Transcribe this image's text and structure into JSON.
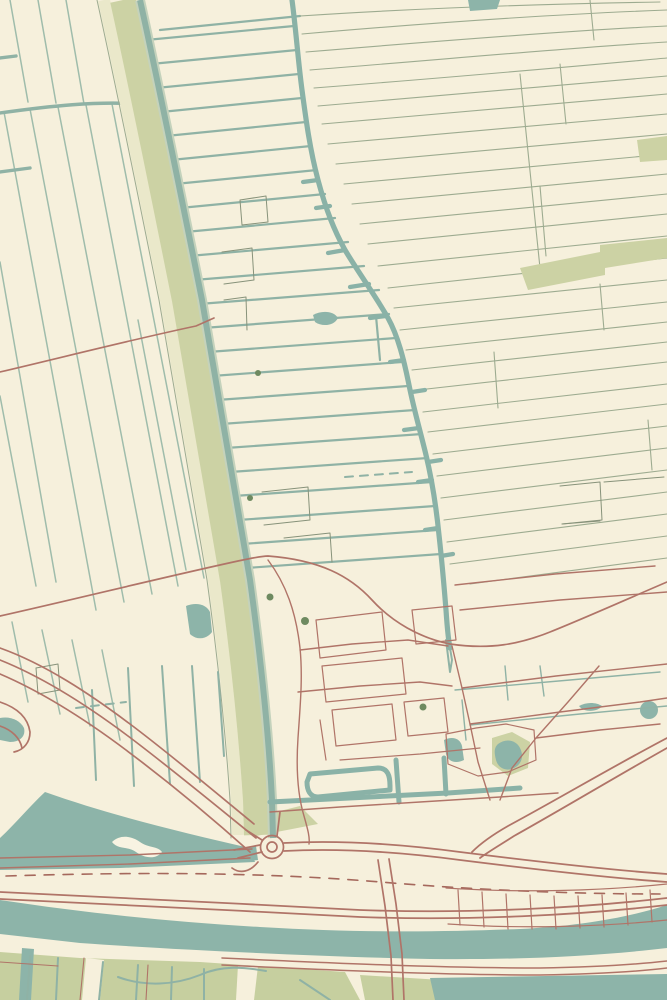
{
  "artwork": {
    "kind": "vintage-style topographic map print",
    "visible_text": "none"
  },
  "palette": {
    "cream": "#f6f0dc",
    "cream_light": "#f8f3e2",
    "water": "#8db4a9",
    "water_deep": "#8ab2a7",
    "ditch": "#8fb2a5",
    "ditch_light": "#9fbcab",
    "field_line": "#9dab90",
    "dark_line": "#87927a",
    "green_band": "#ccd2a4",
    "pale_band": "#eae8ca",
    "olive_field": "#c6cf9f",
    "road_red": "#b07468",
    "road_red_dark": "#a5685c",
    "tree_green": "#6e8a60",
    "casing": "#c4d2bc"
  },
  "map": {
    "width": 667,
    "height": 1000,
    "layers": [
      {
        "name": "background",
        "style": {
          "fill": "cream"
        },
        "paths": [
          "M0,0 H667 V1000 H0 Z"
        ]
      },
      {
        "name": "left-field-lines",
        "style": {
          "stroke": "ditch_light",
          "width": 1.5
        },
        "paths": [
          "M10,0 L28,102",
          "M38,0 L56,103",
          "M66,0 L84,104",
          "M4,112 L96,610",
          "M30,109 L124,602",
          "M58,107 L152,594",
          "M86,105 L178,586",
          "M112,104 L204,578",
          "M0,262 L56,582",
          "M0,396 L36,586",
          "M138,320 L186,570",
          "M12,622 L28,702",
          "M42,630 L60,714",
          "M72,640 L90,726",
          "M102,650 L120,740"
        ]
      },
      {
        "name": "left-cross-ditches",
        "style": {
          "stroke": "ditch",
          "width": 3.4
        },
        "paths": [
          "M0,113 C50,106 96,101 140,104",
          "M0,58 L16,56",
          "M0,172 L30,168"
        ]
      },
      {
        "name": "middle-ditch-lines",
        "style": {
          "stroke": "ditch",
          "width": 2.2
        },
        "paths": [
          "M146,40 L294,26",
          "M151,64 L297,50",
          "M156,88 L299,74",
          "M161,112 L302,98",
          "M166,136 L306,122",
          "M171,160 L311,146",
          "M175,184 L317,170",
          "M180,208 L325,194",
          "M185,232 L335,218",
          "M189,256 L348,242",
          "M194,280 L364,266",
          "M199,304 L379,290",
          "M203,328 L389,314",
          "M208,352 L396,338",
          "M212,376 L402,362",
          "M217,400 L408,386",
          "M221,424 L415,410",
          "M226,448 L422,434",
          "M230,472 L428,458",
          "M234,496 L432,482",
          "M238,520 L435,506",
          "M242,544 L438,530",
          "M246,568 L441,554",
          "M376,316 L380,360",
          "M300,16 L160,30"
        ]
      },
      {
        "name": "right-field-lines",
        "style": {
          "stroke": "field_line",
          "width": 1.1
        },
        "paths": [
          "M300,16 C420,8 540,4 660,2",
          "M302,34 C440,22 560,14 667,10",
          "M306,52 C450,40 580,30 667,26",
          "M310,70 C460,58 590,46 667,42",
          "M314,88 C470,76 600,64 667,58",
          "M318,106 L667,76",
          "M322,124 L667,94",
          "M328,144 L667,114",
          "M336,164 L667,134",
          "M344,184 L667,154",
          "M352,204 L667,174",
          "M360,224 L667,194",
          "M368,244 L667,214",
          "M378,266 L667,236",
          "M388,288 L667,258",
          "M394,308 L667,280",
          "M400,330 L667,302",
          "M406,350 L667,322",
          "M412,370 L667,342",
          "M418,390 L667,362",
          "M423,412 L667,384",
          "M428,432 L667,404",
          "M433,454 L667,426",
          "M437,476 L667,448",
          "M441,498 L667,470",
          "M444,520 L667,492",
          "M447,542 L667,514",
          "M450,564 L667,536",
          "M470,584 L667,558"
        ]
      },
      {
        "name": "right-field-connectors",
        "style": {
          "stroke": "field_line",
          "width": 1.1
        },
        "paths": [
          "M560,64 L566,124",
          "M540,186 L546,256",
          "M520,74 C527,140 534,205 540,268",
          "M494,352 L498,408",
          "M648,420 L652,470",
          "M600,284 L604,330",
          "M590,0 L594,40"
        ]
      },
      {
        "name": "dashed-ditches",
        "style": {
          "stroke": "ditch",
          "width": 2,
          "dash": "8,7"
        },
        "paths": [
          "M76,708 L126,702",
          "M345,477 L412,472"
        ]
      },
      {
        "name": "thin-parcel-outlines",
        "style": {
          "stroke": "dark_line",
          "width": 1
        },
        "paths": [
          "M240,200 L266,196 L268,222 L242,225 Z",
          "M222,252 L252,248 L254,280 L224,284",
          "M224,300 L246,297 L247,330",
          "M262,492 L308,487 L310,520 L264,525",
          "M284,538 L330,533 L332,562",
          "M560,486 L600,482 L602,520 L562,524",
          "M604,482 L664,477",
          "M562,524 L600,521",
          "M36,668 L58,664 L60,690 L38,694 Z"
        ]
      },
      {
        "name": "green-areas",
        "style": {
          "fill": "green_band"
        },
        "paths": [
          "M520,268 L600,252 L600,245 L667,238 L667,258 L605,268 L605,275 L528,290 Z",
          "M637,140 L667,136 L667,160 L640,162 Z",
          "M252,818 L300,806 L318,824 L256,836 Z",
          "M492,738 L512,732 L530,742 L528,768 L508,776 L492,764 Z"
        ]
      },
      {
        "name": "olive-fields-bottom",
        "style": {
          "fill": "olive_field"
        },
        "paths": [
          "M0,952 L80,958 L200,962 L345,972 L360,1000 L0,1000 Z",
          "M360,975 L442,980 L442,1000 L365,1000 Z",
          "M222,985 L300,982 L320,1000 L230,1000 Z"
        ]
      },
      {
        "name": "olive-field-gaps",
        "style": {
          "fill": "cream"
        },
        "paths": [
          "M86,958 L104,960 L100,1000 L82,1000 Z",
          "M238,965 L258,966 L254,1000 L236,1000 Z"
        ]
      },
      {
        "name": "dike-pale-band",
        "style": {
          "stroke": "pale_band",
          "width": 12,
          "cap": "butt"
        },
        "paths": [
          "M104,0 C126,100 146,200 166,300 C184,400 200,500 214,580 C225,660 233,740 237,800 L238,835"
        ]
      },
      {
        "name": "dike-green-band",
        "style": {
          "stroke": "green_band",
          "width": 26,
          "cap": "butt"
        },
        "paths": [
          "M123,0 C145,100 165,200 185,300 C203,400 219,500 233,580 C244,660 252,740 256,800 L257,835"
        ]
      },
      {
        "name": "dike-edge-line",
        "style": {
          "stroke": "field_line",
          "width": 1
        },
        "paths": [
          "M97,0 C119,100 139,200 159,300 C177,400 193,500 207,580 C218,660 226,740 230,800 L231,838"
        ]
      },
      {
        "name": "dike-canal-casing",
        "style": {
          "stroke": "casing",
          "width": 10,
          "cap": "butt"
        },
        "paths": [
          "M140,0 C162,100 182,200 202,300 C220,400 236,500 250,580 C261,660 269,740 272,800 L273,838"
        ]
      },
      {
        "name": "dike-canal",
        "style": {
          "stroke": "ditch",
          "width": 6,
          "cap": "butt"
        },
        "paths": [
          "M140,0 C162,100 182,200 202,300 C220,400 236,500 250,580 C261,660 269,740 272,800 L273,838"
        ]
      },
      {
        "name": "main-canal",
        "style": {
          "stroke": "water_deep",
          "width": 5.2
        },
        "paths": [
          "M292,0 C296,30 298,60 302,90 C306,120 310,150 318,180 C326,210 334,230 345,250 C360,275 375,295 388,318 C398,336 404,360 409,385 C414,410 420,430 426,455 C432,480 436,505 439,535 C442,562 444,585 446,610 C447,625 448,638 450,648"
        ]
      },
      {
        "name": "main-canal-stubs",
        "style": {
          "stroke": "water_deep",
          "width": 4.2
        },
        "paths": [
          "M318,180 l-15,2",
          "M345,250 l-17,3",
          "M369,284 l-19,3",
          "M386,316 l-16,2",
          "M404,360 l-14,2",
          "M419,428 l-15,2",
          "M432,480 l-14,2",
          "M438,528 l-13,2",
          "M412,392 l13,-2",
          "M428,462 l13,-2",
          "M441,556 l12,-2",
          "M330,206 l-14,2"
        ]
      },
      {
        "name": "canal-outflow",
        "style": {
          "stroke": "ditch",
          "width": 2
        },
        "paths": [
          "M450,648 L452,660 L450,672 L446,640"
        ]
      },
      {
        "name": "water-areas",
        "style": {
          "fill": "water"
        },
        "paths": [
          "M0,900 C80,912 160,921 260,927 C360,933 440,932 520,929 C580,926 630,917 667,905 L667,948 C600,956 520,960 430,959 C330,957 180,950 80,943 L0,934 Z",
          "M45,792 C110,815 180,832 250,848 L255,862 L120,868 L0,870 L0,838 C15,824 30,806 45,792 Z",
          "M430,978 L667,974 L667,1000 L435,1000 Z",
          "M22,948 L34,949 L31,1000 L19,1000 Z",
          "M228,849 L256,846 L258,860 L231,863 Z",
          "M186,606 C196,602 206,604 210,612 L212,632 C206,640 196,640 190,634 Z",
          "M0,718 C10,716 20,720 24,728 C26,736 20,742 10,742 L0,740 Z",
          "M498,744 C506,738 516,740 520,748 C524,756 522,764 514,768 C506,772 498,768 496,760 C494,752 494,748 498,744 Z",
          "M579,706 C586,702 596,702 602,706 C598,712 584,713 579,706 Z",
          "M444,740 C452,736 460,738 462,746 L464,760 C456,764 448,762 446,754 Z",
          "M313,315 C322,310 334,311 338,318 C334,326 322,327 315,322 Z",
          "M468,0 L500,0 L497,9 L470,11 Z"
        ],
        "circles": [
          {
            "cx": 649,
            "cy": 710,
            "r": 9
          }
        ]
      },
      {
        "name": "water-island",
        "style": {
          "fill": "cream_light"
        },
        "paths": [
          "M112,842 C120,834 132,836 140,842 C148,848 158,846 162,852 C156,860 144,858 136,852 C128,846 118,850 112,842 Z"
        ]
      },
      {
        "name": "village-ditches",
        "style": {
          "stroke": "water_deep",
          "width": 5
        },
        "paths": [
          "M270,802 C330,799 390,796 448,793 L520,788",
          "M310,774 L378,768 C388,768 390,776 390,786 L390,790 L318,797 C310,797 307,790 307,782 Z",
          "M396,760 L399,802",
          "M444,758 L446,794"
        ]
      },
      {
        "name": "village-thin-ditches",
        "style": {
          "stroke": "ditch",
          "width": 1.4
        },
        "paths": [
          "M455,690 L570,680 L660,672",
          "M470,725 L580,714 L667,706",
          "M462,700 L466,740",
          "M505,666 L508,700",
          "M540,666 L544,696"
        ]
      },
      {
        "name": "lowland-ditches",
        "style": {
          "stroke": "ditch",
          "width": 2
        },
        "paths": [
          "M92,690 L96,780",
          "M128,668 L134,786",
          "M162,666 L170,784",
          "M192,666 L200,782",
          "M218,672 L224,756",
          "M30,956 L27,1000",
          "M58,958 L56,1000",
          "M103,962 L99,1000",
          "M138,965 L136,1000",
          "M172,967 L171,1000",
          "M204,969 L204,1000",
          "M118,977 C145,987 175,985 200,975 C222,965 244,967 266,971",
          "M300,980 L330,1000"
        ]
      },
      {
        "name": "west-cross-road",
        "style": {
          "stroke": "road_red",
          "width": 1.6
        },
        "paths": [
          "M0,372 C60,358 130,340 196,326 L214,318"
        ]
      },
      {
        "name": "village-main-road",
        "style": {
          "stroke": "road_red",
          "width": 1.7
        },
        "paths": [
          "M0,616 C80,598 160,578 238,561 C252,558 262,556 268,556 C320,560 350,576 372,600 C392,622 420,638 450,644 C490,650 520,644 550,632 C585,618 625,600 667,582"
        ]
      },
      {
        "name": "village-streets",
        "style": {
          "stroke": "road_red",
          "width": 1.4
        },
        "paths": [
          "M268,560 C286,584 296,612 300,648 C303,678 300,708 298,738 C296,768 298,796 304,816 C308,830 310,838 309,844",
          "M300,650 L352,644 L408,640 L448,646",
          "M298,692 L360,686 L420,682 L452,686",
          "M270,812 L340,807 L420,802 L500,797 L558,793",
          "M452,646 L462,688 L470,724 L478,762 L490,800",
          "M470,724 L560,712 L640,702 L667,698",
          "M462,688 L556,676 L667,664",
          "M599,666 L568,702 L536,738 L512,768 L500,800",
          "M536,738 L600,730 L660,724",
          "M455,585 L555,574 L655,566",
          "M460,610 L560,600 L667,592"
        ]
      },
      {
        "name": "village-parcels",
        "style": {
          "stroke": "road_red",
          "width": 1.2
        },
        "paths": [
          "M316,620 L382,612 L386,650 L320,658 Z",
          "M322,666 L402,658 L406,694 L326,702 Z",
          "M412,610 L452,606 L456,640 L416,644 Z",
          "M332,710 L392,704 L396,740 L336,746 Z",
          "M404,702 L444,698 L448,732 L408,736 Z",
          "M320,720 L326,760",
          "M340,760 L420,754 L480,748",
          "M446,734 L476,728 L506,724 L534,730 L536,760 L508,772 L478,776 L448,764 Z"
        ]
      },
      {
        "name": "dike-curve-roads",
        "style": {
          "stroke": "road_red",
          "width": 1.7
        },
        "paths": [
          "M0,648 C45,664 90,694 130,724 C170,754 215,792 254,824",
          "M0,660 C45,678 88,706 128,736 C168,766 214,804 256,838",
          "M0,674 C42,692 86,720 126,750 C166,780 212,818 250,852",
          "M0,702 C18,708 28,718 30,732 C30,742 24,750 14,752",
          "M0,726 C12,730 20,738 22,748"
        ]
      },
      {
        "name": "waterfront-road",
        "style": {
          "stroke": "road_red",
          "width": 1.4
        },
        "paths": [
          "M0,858 L130,855 L252,849",
          "M0,868 L130,864 L250,858"
        ]
      },
      {
        "name": "highway-edges",
        "style": {
          "stroke": "road_red",
          "width": 1.8
        },
        "paths": [
          "M284,843 C340,840 400,844 460,852 C540,862 610,870 667,874",
          "M284,851 C340,848 400,852 460,860 C540,870 610,878 667,882",
          "M0,892 C120,897 240,904 360,910 C470,914 580,908 667,898",
          "M0,899 C120,904 240,911 360,917 C470,921 580,915 667,905"
        ]
      },
      {
        "name": "highway-centerline-dashed",
        "style": {
          "stroke": "road_red_dark",
          "width": 1.6,
          "dash": "10,9"
        },
        "paths": [
          "M6,876 C140,872 260,872 380,882 C500,892 600,894 660,894"
        ]
      },
      {
        "name": "merging-highway",
        "style": {
          "stroke": "road_red",
          "width": 1.8
        },
        "paths": [
          "M667,738 C610,768 560,798 508,826 C494,834 480,844 472,852",
          "M667,748 C612,779 564,808 514,836 C500,845 488,852 480,858"
        ]
      },
      {
        "name": "canal-bridge-road",
        "style": {
          "stroke": "road_red",
          "width": 1.7
        },
        "paths": [
          "M378,860 L385,906 L391,956 L393,1000",
          "M389,859 L396,904 L402,954 L404,1000"
        ]
      },
      {
        "name": "harbor-lots",
        "style": {
          "stroke": "road_red",
          "width": 1.2
        },
        "paths": [
          "M446,888 C520,893 600,891 667,884",
          "M448,924 C520,929 600,927 667,920",
          "M458,890 L460,925",
          "M482,892 L484,927",
          "M506,894 L508,929",
          "M530,895 L532,929",
          "M554,896 L556,929",
          "M578,896 L580,928",
          "M602,895 L604,927",
          "M626,893 L628,925",
          "M650,890 L652,922"
        ]
      },
      {
        "name": "south-bank-road",
        "style": {
          "stroke": "road_red",
          "width": 1.5
        },
        "paths": [
          "M222,958 C330,963 440,968 540,968 C600,967 640,964 667,961",
          "M222,965 C330,970 440,975 540,975 C600,974 642,971 667,968"
        ]
      },
      {
        "name": "south-field-roads",
        "style": {
          "stroke": "road_red",
          "width": 1.1
        },
        "paths": [
          "M84,958 L80,1000",
          "M0,962 L58,966",
          "M148,965 L146,1000"
        ]
      },
      {
        "name": "roundabout",
        "style": {
          "stroke": "road_red",
          "width": 1.7
        },
        "paths": [
          "M262,840 L246,830",
          "M260,845 L234,850",
          "M262,852 L238,858",
          "M258,862 C250,872 240,874 232,868",
          "M277,836 L280,812"
        ],
        "circles": [
          {
            "cx": 272,
            "cy": 847,
            "r": 11.5
          },
          {
            "cx": 272,
            "cy": 847,
            "r": 5
          }
        ]
      },
      {
        "name": "tree-marks",
        "style": {
          "fill": "tree_green"
        },
        "circles": [
          {
            "cx": 258,
            "cy": 373,
            "r": 3
          },
          {
            "cx": 250,
            "cy": 498,
            "r": 3
          },
          {
            "cx": 270,
            "cy": 597,
            "r": 3.5
          },
          {
            "cx": 305,
            "cy": 621,
            "r": 4
          },
          {
            "cx": 423,
            "cy": 707,
            "r": 3.5
          }
        ]
      }
    ]
  }
}
